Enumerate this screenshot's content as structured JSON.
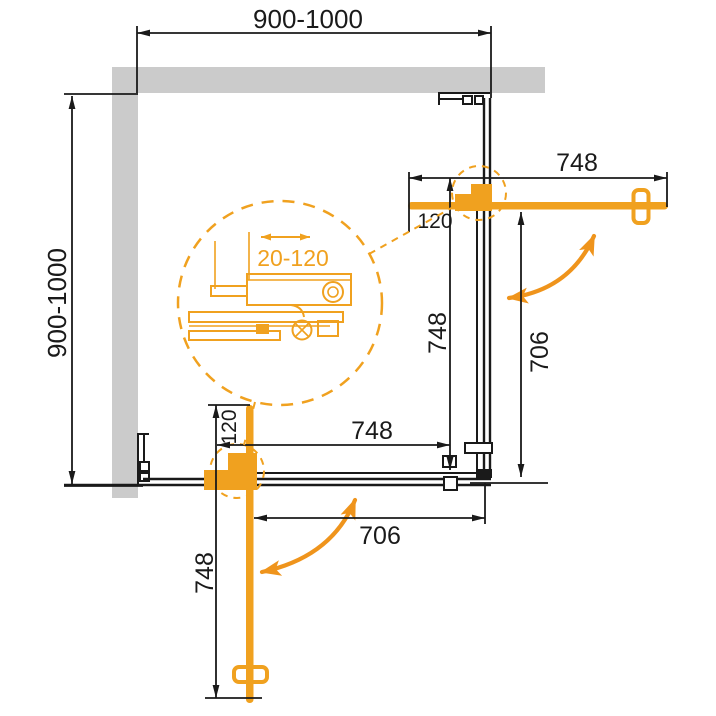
{
  "drawing": {
    "type": "corner-shower-enclosure-plan-view",
    "labels": {
      "width_top": "900-1000",
      "depth_left": "900-1000",
      "right_door_length": "748",
      "right_pivot_offset": "120",
      "right_panel_length": "748",
      "right_opening": "706",
      "bottom_door_length": "748",
      "bottom_pivot_offset": "120",
      "bottom_panel_length": "748",
      "bottom_opening": "706",
      "profile_adjustment": "20-120"
    }
  },
  "colors": {
    "accent_orange": "#F0A11F",
    "swing_arrow_orange": "#EF941C",
    "wall_gray": "#CBCBCB",
    "line_black": "#1A1A1A",
    "background": "#FFFFFF"
  }
}
